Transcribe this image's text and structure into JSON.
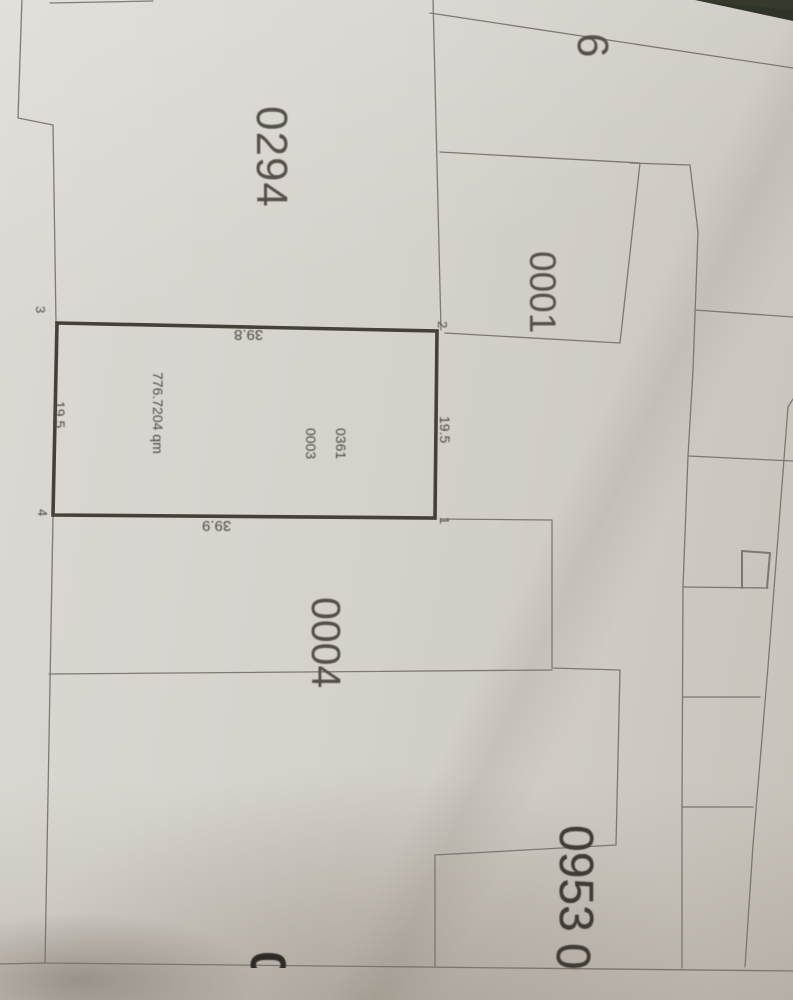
{
  "photo": {
    "description": "Photographed cadastral plan (Flurkarte)",
    "parcels": {
      "p0294": "0294",
      "p6": "6",
      "p0001": "0001",
      "p0004": "0004",
      "p0953": "0953"
    },
    "subject_parcel": {
      "flur_ref": "0361",
      "number": "0003",
      "area": "776.7204 qm",
      "corners": {
        "c1": "1",
        "c2": "2",
        "c3": "3",
        "c4": "4"
      },
      "dimensions": {
        "top": "39.8",
        "bottom": "39.9",
        "left": "19.5",
        "right": "19.5"
      }
    },
    "partial_digits": {
      "bottom_center": "0",
      "below_0953": "0"
    },
    "colors": {
      "paper": "#d4d1cb",
      "ink": "#4e4a44",
      "thin_line": "#76716b",
      "bold_outline": "#454139",
      "background_dark": "#2f3328"
    }
  }
}
